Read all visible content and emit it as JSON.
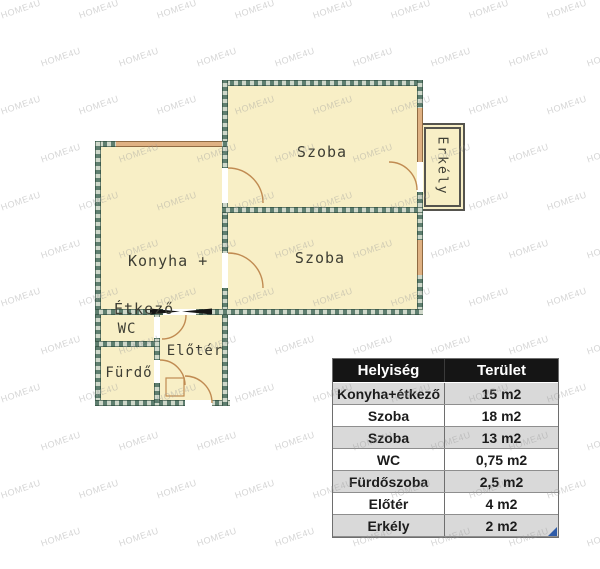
{
  "plan": {
    "rooms": {
      "szoba_top": "Szoba",
      "szoba_bottom": "Szoba",
      "konyha_line1": "Konyha +",
      "konyha_line2": "Étkező",
      "wc": "WC",
      "eloter": "Előtér",
      "furdo": "Fürdő",
      "erkely": "Erkély"
    },
    "colors": {
      "room_fill": "#f8efc6",
      "wall_dark": "#5e7e6f",
      "wall_light": "#cfd8ca",
      "window": "#dfb183",
      "door_arc": "#c08b52",
      "balcony_border": "#55544e",
      "entrance_marker": "#151515"
    }
  },
  "area_table": {
    "headers": [
      "Helyiség",
      "Terület"
    ],
    "rows": [
      {
        "name": "Konyha+étkező",
        "area": "15 m2"
      },
      {
        "name": "Szoba",
        "area": "18 m2"
      },
      {
        "name": "Szoba",
        "area": "13 m2"
      },
      {
        "name": "WC",
        "area": "0,75 m2"
      },
      {
        "name": "Fürdőszoba",
        "area": "2,5 m2"
      },
      {
        "name": "Előtér",
        "area": "4 m2"
      },
      {
        "name": "Erkély",
        "area": "2 m2"
      }
    ],
    "header_bg": "#151515",
    "row_alt_bg": "#d9d9d9",
    "corner_color": "#2f5ca8"
  },
  "watermark": {
    "text": "HOME4U"
  }
}
